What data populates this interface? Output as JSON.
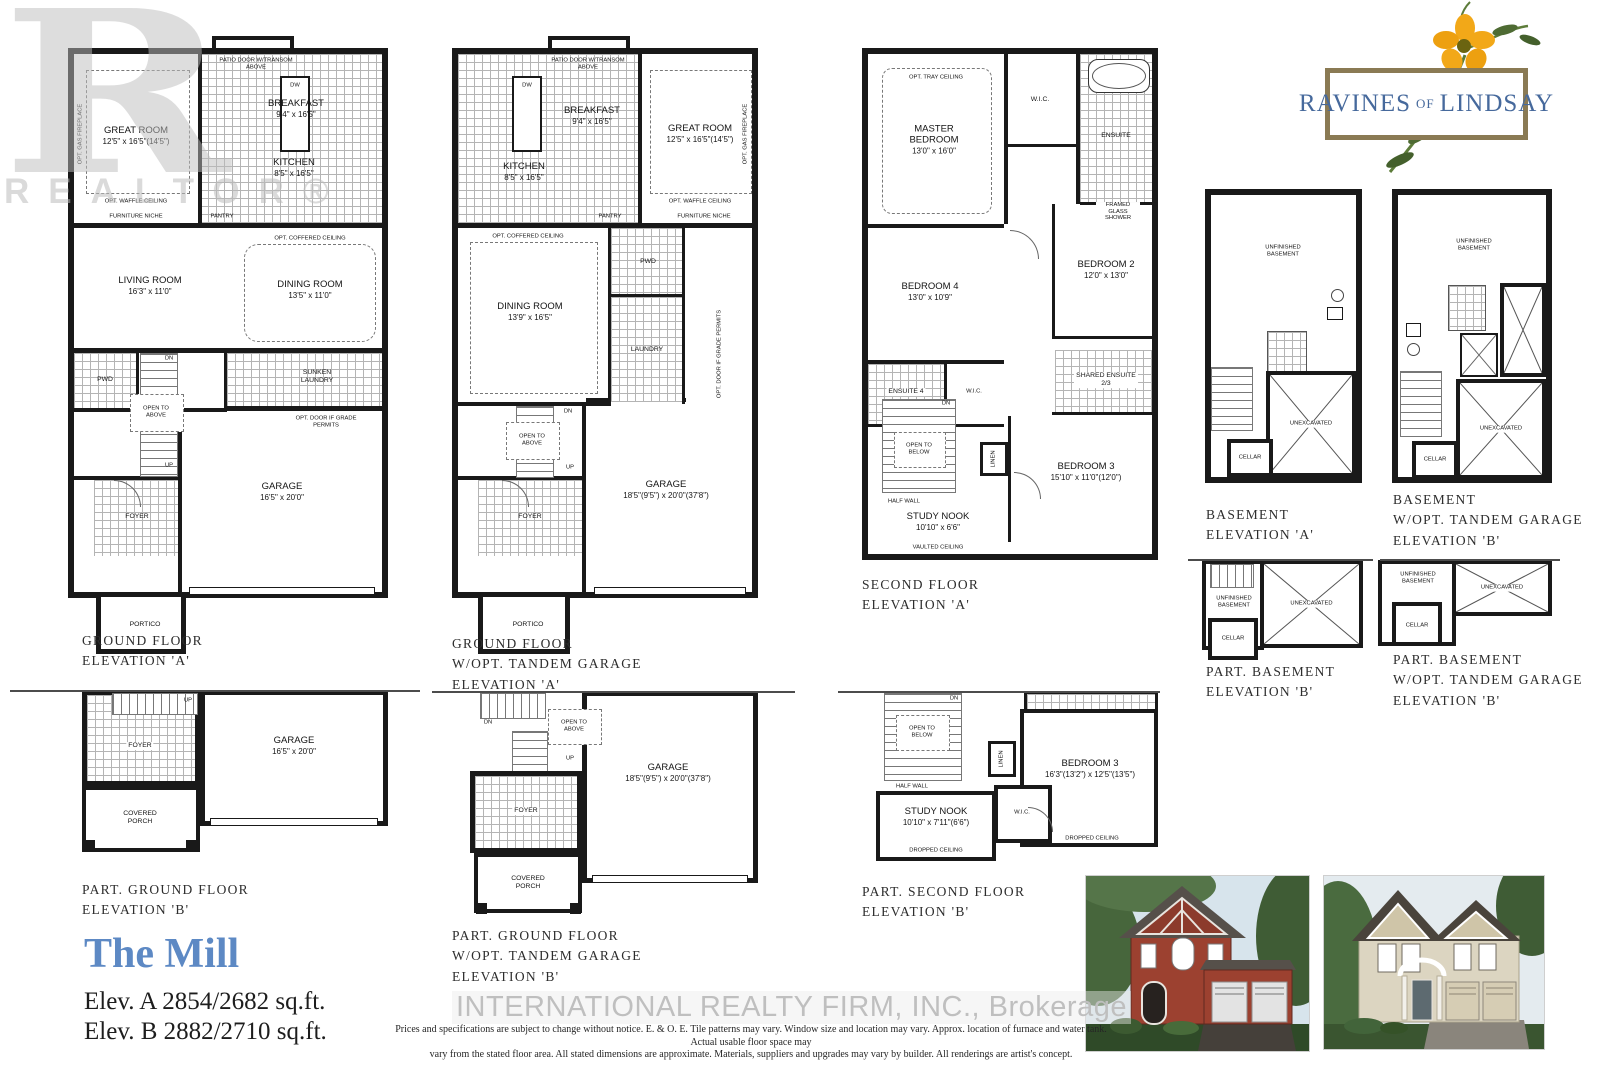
{
  "branding": {
    "realtor_mark": "R",
    "realtor_label": "REALTOR®",
    "community": {
      "ravines": "RAVINES",
      "of": "OF",
      "lindsay": "LINDSAY"
    },
    "brokerage_watermark": "INTERNATIONAL REALTY FIRM, INC., Brokerage",
    "icons": {
      "flower": "yellow-flower"
    }
  },
  "model": {
    "name": "The Mill",
    "elev_a": "Elev. A 2854/2682 sq.ft.",
    "elev_b": "Elev. B 2882/2710 sq.ft."
  },
  "disclaimer": {
    "line1": "Prices and specifications are subject to change without notice. E. & O. E. Tile patterns may vary. Window size and location may vary. Approx. location of furnace and water tank. Actual usable floor space may",
    "line2": "vary from the stated floor area. All stated dimensions are approximate. Materials, suppliers and upgrades may vary by builder. All renderings are artist's concept."
  },
  "plans": {
    "ground_a": {
      "caption": [
        "GROUND FLOOR",
        "ELEVATION 'A'"
      ],
      "rooms": {
        "great": {
          "name": "GREAT ROOM",
          "dims": "12'5\" x 16'5\"(14'5\")"
        },
        "breakfast": {
          "name": "BREAKFAST",
          "dims": "9'4\" x 16'5\""
        },
        "kitchen": {
          "name": "KITCHEN",
          "dims": "8'5\" x 16'5\""
        },
        "living": {
          "name": "LIVING ROOM",
          "dims": "16'3\" x 11'0\""
        },
        "dining": {
          "name": "DINING ROOM",
          "dims": "13'5\" x 11'0\""
        },
        "pwd": {
          "name": "PWD"
        },
        "laundry": {
          "name": "SUNKEN LAUNDRY"
        },
        "foyer": {
          "name": "FOYER"
        },
        "garage": {
          "name": "GARAGE",
          "dims": "16'5\" x 20'0\""
        },
        "portico": {
          "name": "PORTICO"
        }
      },
      "notes": {
        "patio": "PATIO DOOR W/TRANSOM ABOVE",
        "waffle": "OPT. WAFFLE CEILING",
        "niche": "FURNITURE NICHE",
        "pantry": "PANTRY",
        "coffered": "OPT. COFFERED CEILING",
        "open_above": "OPEN TO ABOVE",
        "up": "UP",
        "dn": "DN",
        "dw": "DW",
        "gas": "OPT. GAS FIREPLACE",
        "grade": "OPT. DOOR IF GRADE PERMITS"
      }
    },
    "ground_tandem_a": {
      "caption": [
        "GROUND FLOOR",
        "W/OPT. TANDEM GARAGE",
        "ELEVATION 'A'"
      ],
      "rooms": {
        "great": {
          "name": "GREAT ROOM",
          "dims": "12'5\" x 16'5\"(14'5\")"
        },
        "breakfast": {
          "name": "BREAKFAST",
          "dims": "9'4\" x 16'5\""
        },
        "kitchen": {
          "name": "KITCHEN",
          "dims": "8'5\" x 16'5\""
        },
        "dining": {
          "name": "DINING ROOM",
          "dims": "13'9\" x 16'5\""
        },
        "pwd": {
          "name": "PWD"
        },
        "laundry": {
          "name": "LAUNDRY"
        },
        "foyer": {
          "name": "FOYER"
        },
        "garage": {
          "name": "GARAGE",
          "dims": "18'5\"(9'5\") x 20'0\"(37'8\")"
        },
        "portico": {
          "name": "PORTICO"
        }
      },
      "notes": {
        "patio": "PATIO DOOR W/TRANSOM ABOVE",
        "waffle": "OPT. WAFFLE CEILING",
        "niche": "FURNITURE NICHE",
        "pantry": "PANTRY",
        "coffered": "OPT. COFFERED CEILING",
        "open_above": "OPEN TO ABOVE",
        "up": "UP",
        "dn": "DN",
        "dw": "DW",
        "gas": "OPT. GAS FIREPLACE",
        "grade": "OPT. DOOR IF GRADE PERMITS"
      }
    },
    "second_a": {
      "caption": [
        "SECOND FLOOR",
        "ELEVATION 'A'"
      ],
      "rooms": {
        "master": {
          "name": "MASTER BEDROOM",
          "dims": "13'0\" x 16'0\""
        },
        "wic": {
          "name": "W.I.C."
        },
        "ensuite": {
          "name": "ENSUITE"
        },
        "bed4": {
          "name": "BEDROOM 4",
          "dims": "13'0\" x 10'9\""
        },
        "bed2": {
          "name": "BEDROOM 2",
          "dims": "12'0\" x 13'0\""
        },
        "ensuite4": {
          "name": "ENSUITE 4"
        },
        "wic2": {
          "name": "W.I.C."
        },
        "shared": {
          "name": "SHARED ENSUITE 2/3"
        },
        "bed3": {
          "name": "BEDROOM 3",
          "dims": "15'10\" x 11'0\"(12'0\")"
        },
        "study": {
          "name": "STUDY NOOK",
          "dims": "10'10\" x 6'6\""
        },
        "linen": {
          "name": "LINEN"
        }
      },
      "notes": {
        "tray": "OPT. TRAY CEILING",
        "open_below": "OPEN TO BELOW",
        "dn": "DN",
        "half": "HALF WALL",
        "vaulted": "VAULTED CEILING",
        "framed": "FRAMED GLASS SHOWER"
      }
    },
    "basement_a": {
      "caption": [
        "BASEMENT",
        "ELEVATION 'A'"
      ],
      "rooms": {
        "unfinished": {
          "name": "UNFINISHED BASEMENT"
        },
        "unexcavated": {
          "name": "UNEXCAVATED"
        },
        "cellar": {
          "name": "CELLAR"
        }
      }
    },
    "basement_b": {
      "caption": [
        "BASEMENT",
        "W/OPT. TANDEM GARAGE",
        "ELEVATION 'B'"
      ],
      "rooms": {
        "unfinished": {
          "name": "UNFINISHED BASEMENT"
        },
        "unexcavated": {
          "name": "UNEXCAVATED"
        },
        "cellar": {
          "name": "CELLAR"
        }
      }
    },
    "part_ground_b": {
      "caption": [
        "PART. GROUND FLOOR",
        "ELEVATION 'B'"
      ],
      "rooms": {
        "foyer": {
          "name": "FOYER"
        },
        "porch": {
          "name": "COVERED PORCH"
        },
        "garage": {
          "name": "GARAGE",
          "dims": "16'5\" x 20'0\""
        }
      },
      "notes": {
        "up": "UP"
      }
    },
    "part_ground_tandem_b": {
      "caption": [
        "PART. GROUND FLOOR",
        "W/OPT. TANDEM GARAGE",
        "ELEVATION 'B'"
      ],
      "rooms": {
        "foyer": {
          "name": "FOYER"
        },
        "porch": {
          "name": "COVERED PORCH"
        },
        "garage": {
          "name": "GARAGE",
          "dims": "18'5\"(9'5\") x 20'0\"(37'8\")"
        }
      },
      "notes": {
        "open_above": "OPEN TO ABOVE",
        "up": "UP",
        "dn": "DN"
      }
    },
    "part_second_b": {
      "caption": [
        "PART. SECOND FLOOR",
        "ELEVATION 'B'"
      ],
      "rooms": {
        "study": {
          "name": "STUDY NOOK",
          "dims": "10'10\" x 7'11\"(6'6\")"
        },
        "bed3": {
          "name": "BEDROOM 3",
          "dims": "16'3\"(13'2\") x 12'5\"(13'5\")"
        },
        "wic": {
          "name": "W.I.C."
        },
        "linen": {
          "name": "LINEN"
        }
      },
      "notes": {
        "open_below": "OPEN TO BELOW",
        "dn": "DN",
        "half": "HALF WALL",
        "dropped": "DROPPED CEILING"
      }
    },
    "part_basement_b": {
      "caption": [
        "PART. BASEMENT",
        "ELEVATION 'B'"
      ],
      "rooms": {
        "unfinished": {
          "name": "UNFINISHED BASEMENT"
        },
        "unexcavated": {
          "name": "UNEXCAVATED"
        },
        "cellar": {
          "name": "CELLAR"
        }
      }
    },
    "part_basement_tandem_b": {
      "caption": [
        "PART. BASEMENT",
        "W/OPT. TANDEM GARAGE",
        "ELEVATION 'B'"
      ],
      "rooms": {
        "unfinished": {
          "name": "UNFINISHED BASEMENT"
        },
        "unexcavated": {
          "name": "UNEXCAVATED"
        },
        "cellar": {
          "name": "CELLAR"
        }
      }
    }
  }
}
